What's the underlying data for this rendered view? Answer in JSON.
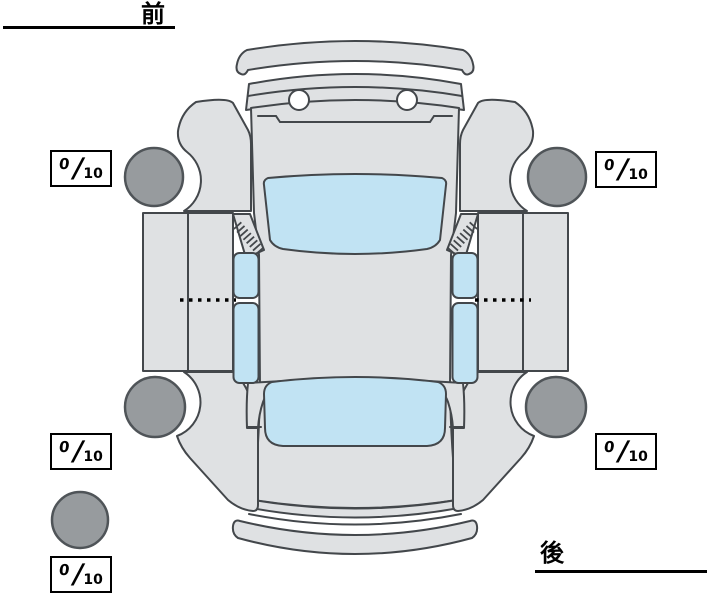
{
  "labels": {
    "front": "前",
    "rear": "後"
  },
  "score_boxes": [
    {
      "id": "front-left",
      "value": "0",
      "separator": "/",
      "max": "10"
    },
    {
      "id": "front-right",
      "value": "0",
      "separator": "/",
      "max": "10"
    },
    {
      "id": "rear-left",
      "value": "0",
      "separator": "/",
      "max": "10"
    },
    {
      "id": "rear-right",
      "value": "0",
      "separator": "/",
      "max": "10"
    },
    {
      "id": "spare",
      "value": "0",
      "separator": "/",
      "max": "10"
    }
  ],
  "diagram": {
    "type": "car-top-view-condition-sheet",
    "tires": [
      "front-left",
      "front-right",
      "rear-left",
      "rear-right",
      "spare"
    ]
  },
  "colors": {
    "background": "#ffffff",
    "body": "#dfe1e3",
    "outline": "#43474b",
    "glass": "#c1e3f3",
    "tire": "#979b9e",
    "tire_outline": "#4f5458",
    "ink": "#000000",
    "white": "#ffffff"
  }
}
